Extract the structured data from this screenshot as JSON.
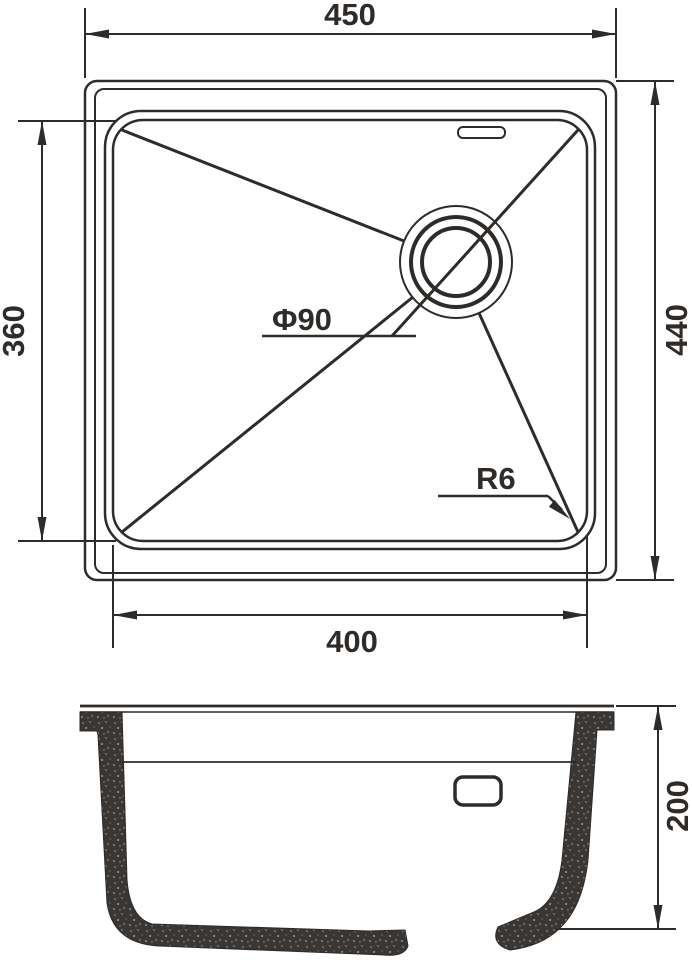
{
  "top_view": {
    "dim_width_overall": "450",
    "dim_width_bowl": "400",
    "dim_height_bowl": "360",
    "dim_height_overall": "440",
    "drain_diameter_label": "Φ90",
    "corner_radius_label": "R6"
  },
  "side_view": {
    "dim_depth": "200"
  },
  "colors": {
    "line": "#2e2b28",
    "granite_fill": "#3a3633",
    "background": "#ffffff"
  }
}
